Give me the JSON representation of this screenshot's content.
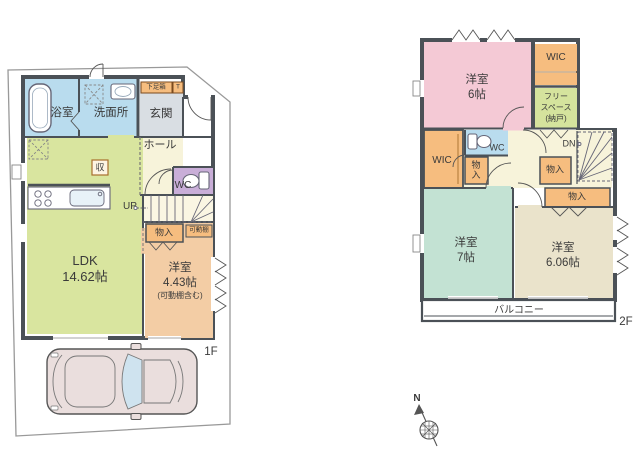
{
  "floor1": {
    "label": "1F",
    "bath": "浴室",
    "washroom": "洗面所",
    "entrance": "玄関",
    "shoe_cabinet": "下足箱",
    "shoe_cabinet_t": "T",
    "hall": "ホール",
    "wc": "WC",
    "up": "UP",
    "storage_mark": "収",
    "ldk_name": "LDK",
    "ldk_size": "14.62帖",
    "closet": "物入",
    "movable_shelf": "可動棚",
    "bedroom_name": "洋室",
    "bedroom_size": "4.43帖",
    "bedroom_note": "(可動棚含む)"
  },
  "floor2": {
    "label": "2F",
    "bedroom1_name": "洋室",
    "bedroom1_size": "6帖",
    "wic_top": "WIC",
    "free_space_1": "フリー",
    "free_space_2": "スペース",
    "free_space_3": "(納戸)",
    "wc": "WC",
    "wic_left": "WIC",
    "closet_small": "物入",
    "dn": "DN",
    "closet_mid": "物入",
    "closet_wide": "物入",
    "bedroom2_name": "洋室",
    "bedroom2_size": "7帖",
    "bedroom3_name": "洋室",
    "bedroom3_size": "6.06帖",
    "balcony": "バルコニー"
  },
  "compass": {
    "north": "N"
  },
  "colors": {
    "wall": "#4b5157",
    "water_blue": "#b9dcee",
    "ldk_green": "#d9e59f",
    "bedroom_peach": "#f3cda5",
    "storage_orange": "#f6bd7f",
    "pink": "#f4c9d5",
    "teal": "#c3e2d3",
    "beige": "#eae3cb",
    "wc_purple": "#c9aed8",
    "hall_cream": "#f7f3da",
    "entrance_gray": "#d9dee3",
    "free_space_green": "#d5e39d",
    "boundary": "#999999"
  }
}
